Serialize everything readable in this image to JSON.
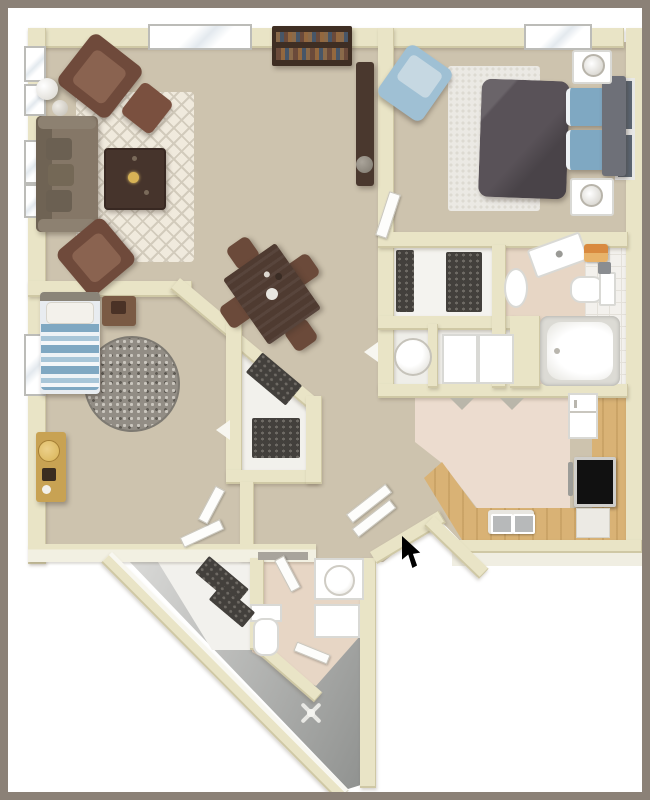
{
  "meta": {
    "kind": "3d-rendered apartment floor plan, top-down view",
    "text_content": "none — image contains no visible text or labels",
    "overlay": {
      "cursor": "black mouse cursor arrow pointing up-left, located near the entry door notch"
    }
  },
  "palette": {
    "frame": "#8b8177",
    "wall": "#e9e4c6",
    "wall_edge": "#cfc9a5",
    "carpet": "#cdc3ae",
    "rug_living": "#f0eadd",
    "rug_lattice": "#d2cbbc",
    "rug_fuzzy": "#ebe9e4",
    "rug_round": "#928d85",
    "wood": "#d9b275",
    "kitchen_floor": "#ecdccf",
    "bath_floor": "#e7d6c5",
    "tile": "#f3f1ed",
    "entry_light": "#dcdcda",
    "entry_dark": "#8e908e",
    "sofa": "#857767",
    "sofa_dark": "#6b6052",
    "armchair": "#6f4a3b",
    "armchair_seat": "#8a6350",
    "table_dark": "#46342c",
    "dining_wood": "#4f3b31",
    "chair_wood": "#6b4a3a",
    "bed_gray": "#595258",
    "bed_blue": "#7fa8c2",
    "chair_blue": "#9fc0d4",
    "chair_blue_light": "#c6d8e2",
    "headboard": "#6e7078",
    "frame_art": "#5c6672",
    "shoes": "#43403c",
    "white_fixture": "#ffffff",
    "fixture_shadow": "#d9d9d5",
    "accent_orange": "#d98a3f",
    "accent_gold": "#d8b356",
    "dresser_gold": "#c8a253",
    "cursor": "#000000"
  },
  "rooms": [
    {
      "id": "living-room",
      "items": [
        "sofa",
        "armchair",
        "ottoman",
        "armchair",
        "coffee-table",
        "trellis-rug",
        "floor-lamp",
        "bookshelf",
        "tv-console",
        "windows"
      ]
    },
    {
      "id": "dining-area",
      "items": [
        "dining-table",
        "dining-chair x4"
      ]
    },
    {
      "id": "master-bedroom",
      "items": [
        "bed-gray-comforter",
        "blue-pillows",
        "headboard",
        "nightstand x2",
        "lamp x2",
        "blue-armchair",
        "fuzzy-rug",
        "skylight",
        "wall-art x2"
      ]
    },
    {
      "id": "hall-bathroom",
      "items": [
        "toilet",
        "pedestal-sink",
        "vanity",
        "orange-towels",
        "bathtub",
        "tile-floor"
      ]
    },
    {
      "id": "walk-in-closet",
      "items": [
        "shoe-racks"
      ]
    },
    {
      "id": "utility-closets",
      "items": [
        "water-heater",
        "washer-dryer-doors"
      ]
    },
    {
      "id": "kitchen",
      "items": [
        "refrigerator",
        "stove",
        "double-sink",
        "wood-counters",
        "base-cabinet"
      ]
    },
    {
      "id": "second-bedroom",
      "items": [
        "striped-bed",
        "nightstand",
        "round-speckled-rug",
        "gold-dresser",
        "window"
      ]
    },
    {
      "id": "hall-closet",
      "items": [
        "shoe-racks"
      ]
    },
    {
      "id": "entry-wing",
      "items": [
        "shoe-closet",
        "toilet",
        "round-sink-vanity",
        "cabinet",
        "fan-fixture",
        "open-doors",
        "diagonal-walls"
      ]
    }
  ]
}
